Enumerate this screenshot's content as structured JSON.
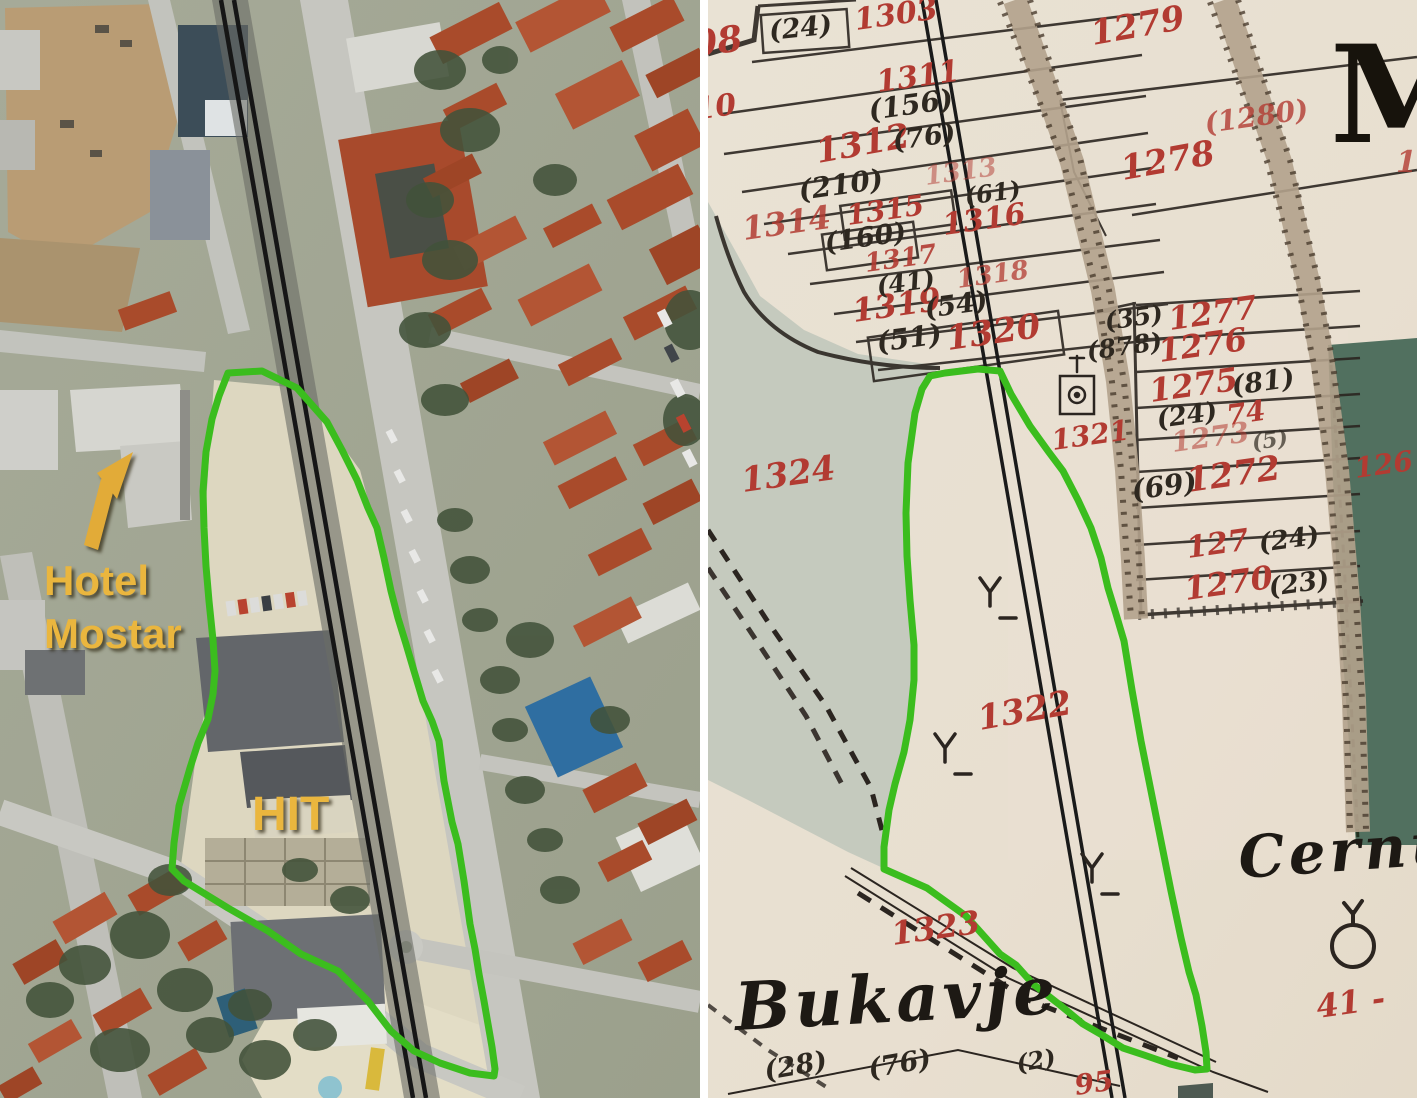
{
  "panels": {
    "left": {
      "description": "aerial satellite photo of Mostar with highlighted parcel",
      "annotations": {
        "hotel_line1": "Hotel",
        "hotel_line2": "Mostar",
        "hit": "HIT"
      }
    },
    "right": {
      "description": "historic cadastral map sheet of the same parcel",
      "place_names": {
        "bukavje": "Bukavje",
        "cernu_partial": "Cernu",
        "m_partial": "M"
      },
      "red_parcel_numbers": [
        "08",
        "1303",
        "10",
        "1311",
        "1312",
        "1313",
        "1314",
        "1315",
        "1316",
        "1317",
        "1318",
        "1319",
        "1320",
        "1279",
        "(1280)",
        "1278",
        "1",
        "1277",
        "1276",
        "1275",
        "74",
        "1273",
        "1272",
        "127",
        "1270",
        "126",
        "1321",
        "1324",
        "1322",
        "1323",
        "95",
        "41 -"
      ],
      "black_parcel_numbers": [
        "(24)",
        "(156)",
        "(76)",
        "(210)",
        "(61)",
        "(160)",
        "(41)",
        "(54)",
        "(51)",
        "(35)",
        "(878)",
        "(81)",
        "(24)",
        "(5)",
        "(69)",
        "(24)",
        "(23)",
        "(28)",
        "(76)",
        "(2)"
      ]
    }
  },
  "colors": {
    "highlight_green": "#3bbd1e",
    "annotation_yellow": "#eab63e",
    "parcel_red": "#b23b32",
    "map_ink": "#2b2520",
    "map_paper": "#e8e1d3"
  }
}
